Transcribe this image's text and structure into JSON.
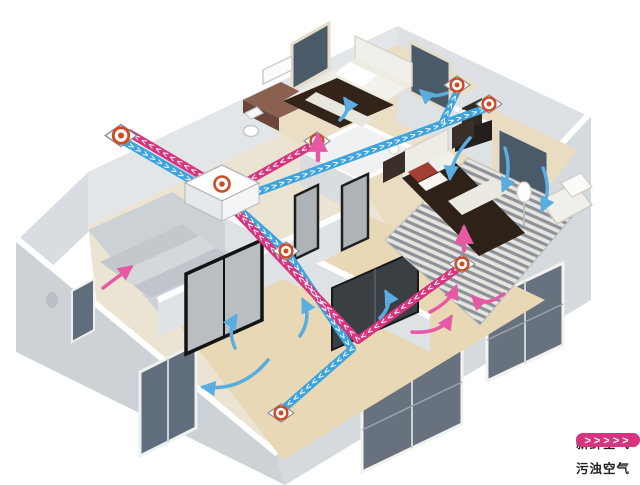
{
  "colors": {
    "fresh_air": "#3fa3dc",
    "polluted_air": "#d6357f",
    "fan_ring": "#d14a26",
    "wall_face": "#dfe3e6",
    "wall_dark": "#c9ced3",
    "wall_top": "#ffffff",
    "floor_wood": "#e8dabb",
    "window_glass": "#5f6d7c",
    "arrow_blue": "#5aade0",
    "arrow_pink": "#e65aa5"
  },
  "icons": {
    "fan_vent": "concentric-circle-fan-icon",
    "flow_arrow_fresh": "curved-arrow-blue",
    "flow_arrow_exhaust": "curved-arrow-pink"
  },
  "ducts": {
    "chevrons": ">>>>>>>>>>>>>>>>>>>>>>>>>>>>>>>>>>>>>>>>>>>>>>>>>>>>>>>>>>>>"
  },
  "legend": {
    "items": [
      {
        "id": "fresh-air",
        "label": "新鲜空气",
        "color": "#45a7d8",
        "chevrons": ">>>>>"
      },
      {
        "id": "polluted-air",
        "label": "污浊空气",
        "color": "#d6357f",
        "chevrons": ">>>>>"
      }
    ]
  }
}
